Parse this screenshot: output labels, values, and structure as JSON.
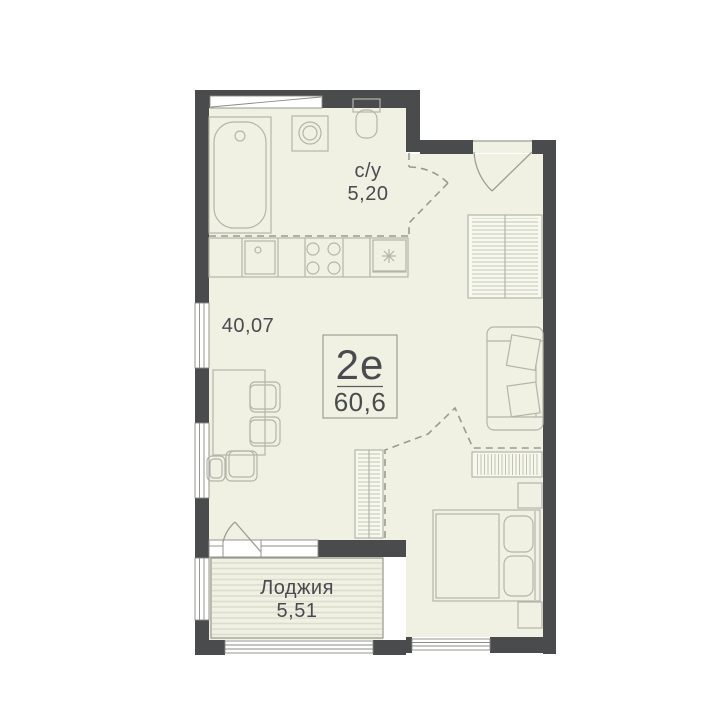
{
  "unit": {
    "type_label": "2е",
    "total_area": "60,6"
  },
  "rooms": {
    "bathroom": {
      "name": "с/у",
      "area": "5,20"
    },
    "living": {
      "area": "40,07"
    },
    "loggia": {
      "name": "Лоджия",
      "area": "5,51"
    }
  },
  "colors": {
    "wall": "#4a4b4d",
    "floor": "#f0f1e3",
    "line": "#b4b5a9",
    "line2": "#9d9e93",
    "dash": "#9a9b90",
    "text": "#4a4b4f",
    "frame": "#8b8c84",
    "furnfill": "#f7f8ee"
  },
  "furniture_icons": [
    "bathtub-icon",
    "washing-machine-icon",
    "toilet-icon",
    "kitchen-sink-icon",
    "stove-icon",
    "fridge-icon",
    "dining-table-icon",
    "chair-icon",
    "stool-icon",
    "wardrobe-icon",
    "sofa-icon",
    "shelving-icon",
    "dresser-icon",
    "bed-icon",
    "nightstand-icon"
  ]
}
